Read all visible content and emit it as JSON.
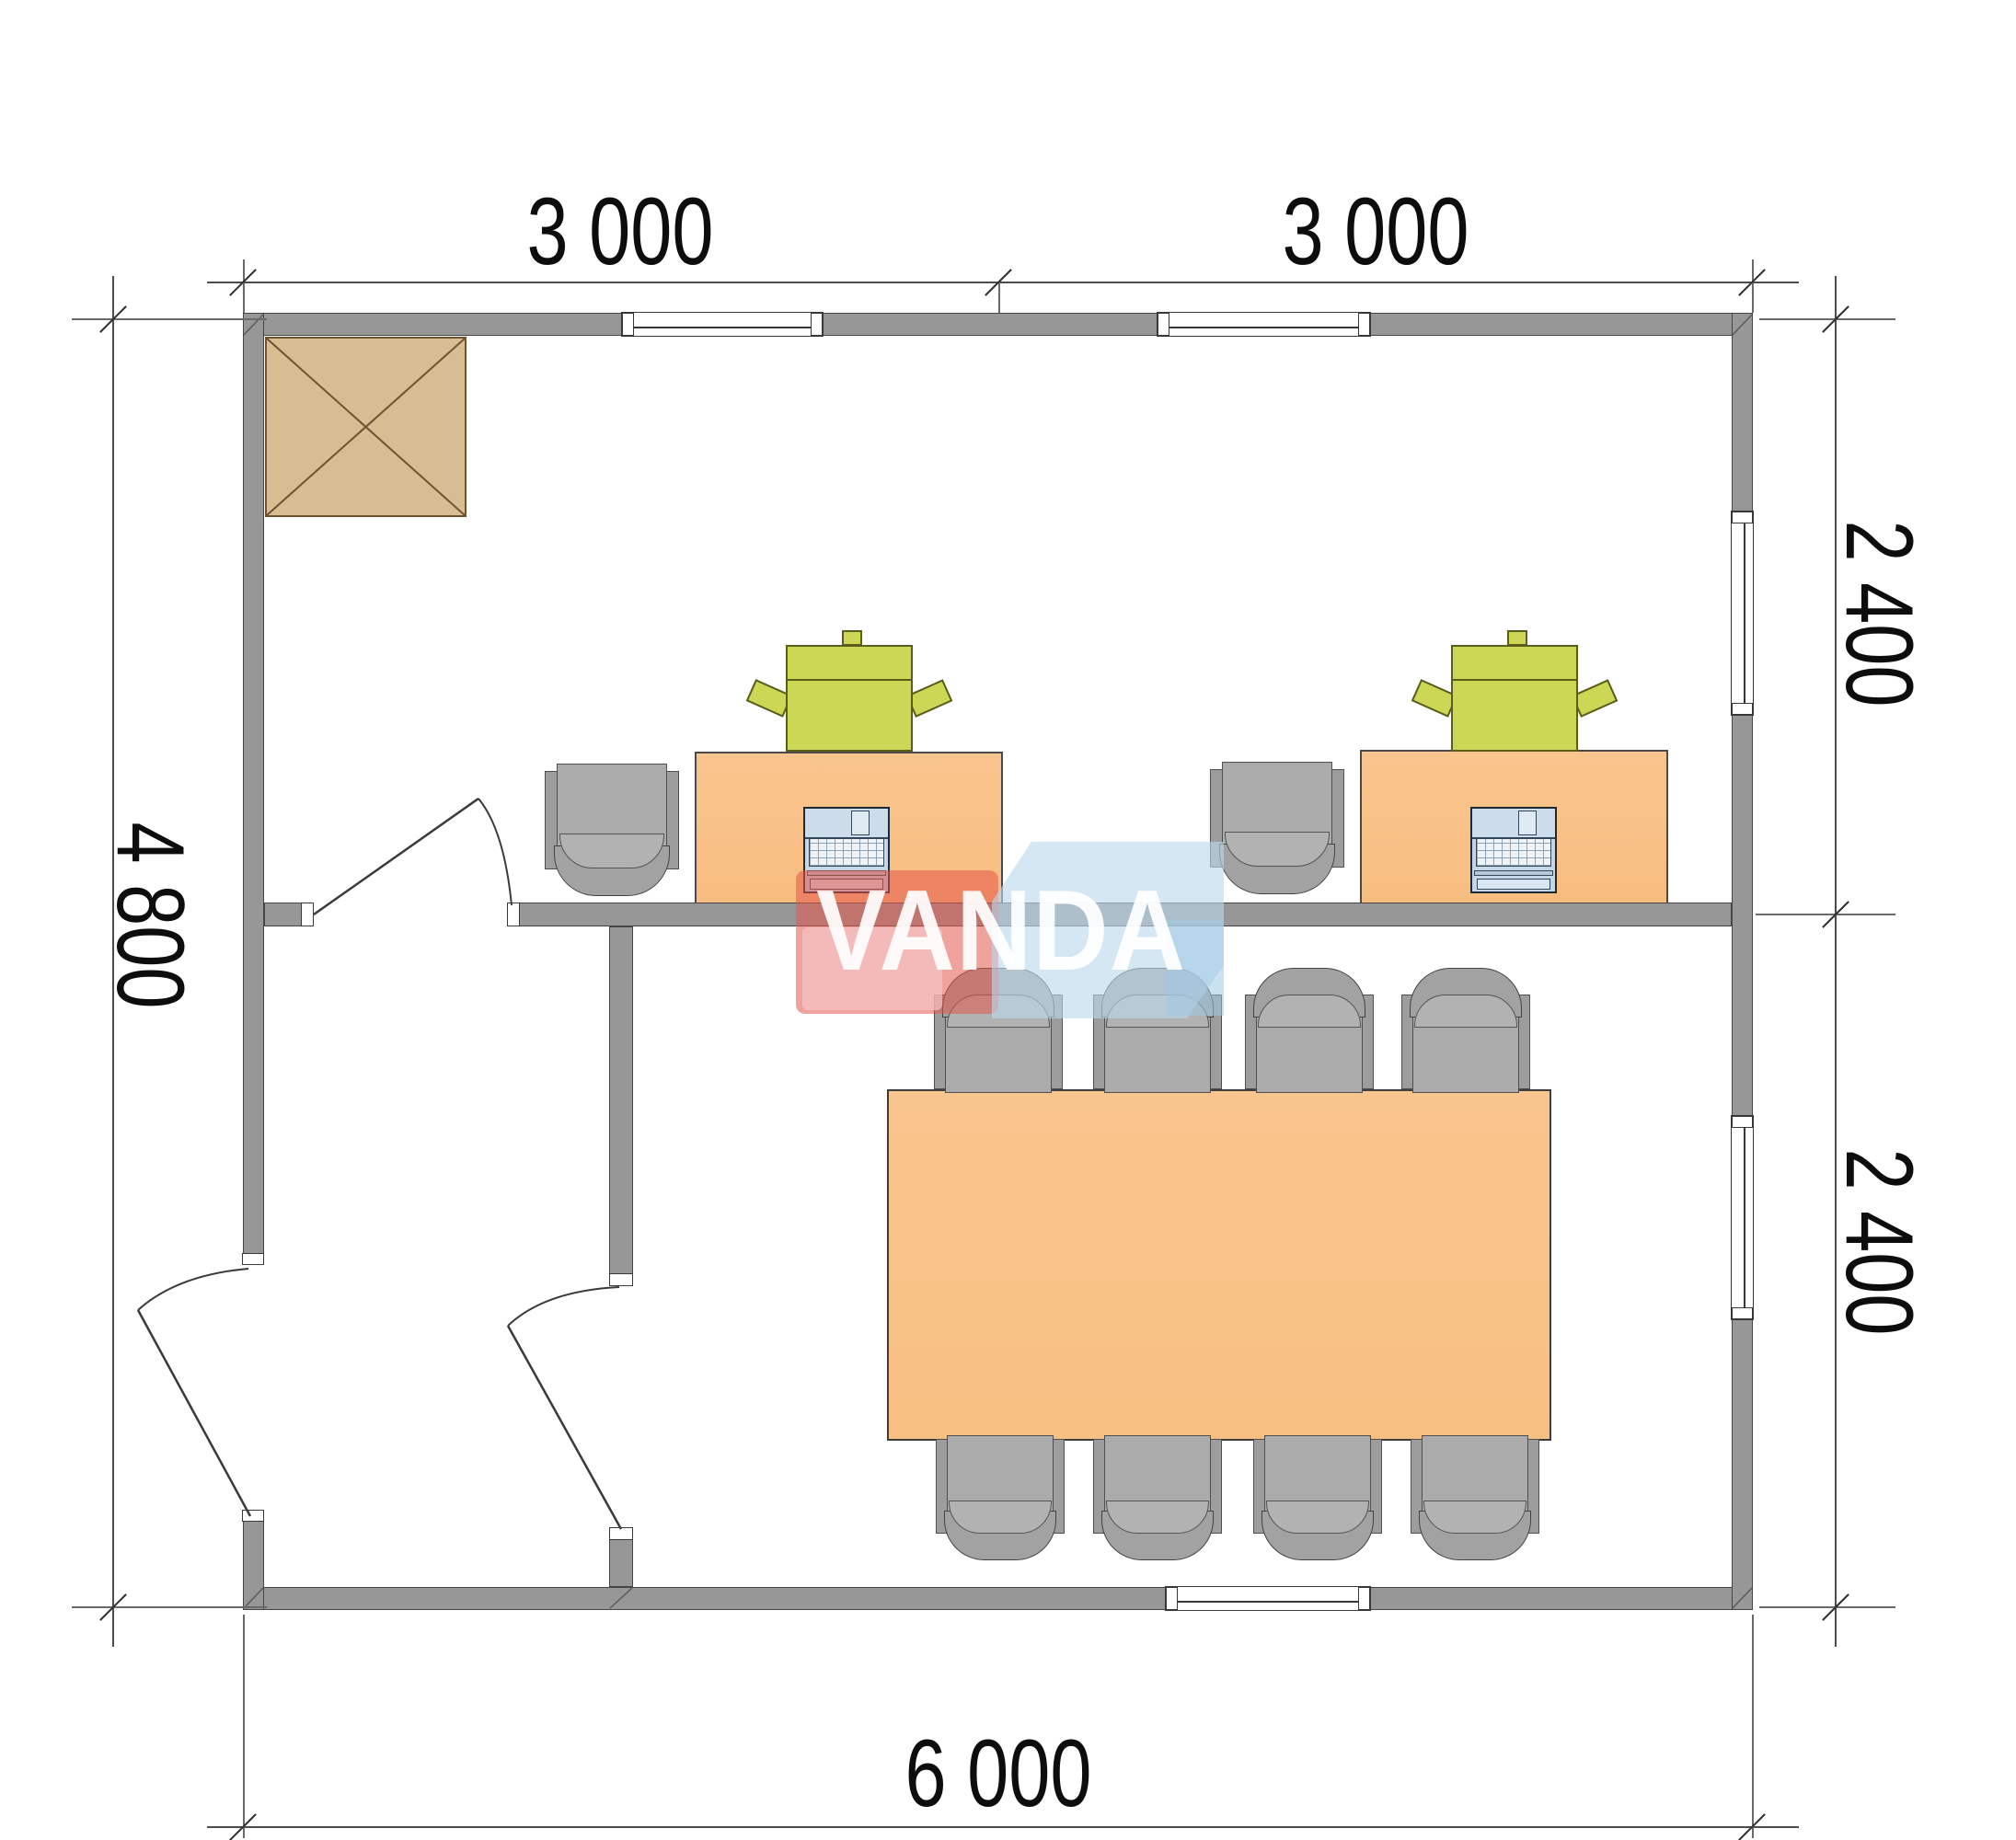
{
  "document": {
    "type": "floor-plan",
    "units": "mm",
    "building": {
      "width_label": "6 000",
      "depth_label": "4 800"
    }
  },
  "dimensions": {
    "top": [
      "3 000",
      "3 000"
    ],
    "right": [
      "2 400",
      "2 400"
    ],
    "left": "4 800",
    "bottom": "6 000"
  },
  "watermark": {
    "brand": "VANDA"
  },
  "colors": {
    "wall_fill": "#979797",
    "wall_stroke": "#454545",
    "desk_fill": "#f8c083",
    "printer_fill": "#cbd755",
    "chair_fill": "#ababab",
    "chimney_fill": "#d8bc92",
    "logo_red": "#e4564a",
    "logo_pink": "#f3c4c6",
    "logo_blue": "#bcd8eb",
    "logo_text": "#ffffff",
    "dimension_text": "#0d0d0d"
  },
  "rooms": {
    "office": {
      "furniture": [
        "desk-left",
        "desk-right",
        "office-chair-left",
        "office-chair-right",
        "printer-left",
        "printer-right",
        "laptop-left",
        "laptop-right",
        "chimney"
      ]
    },
    "meeting_room": {
      "furniture": [
        "conference-table",
        "conference-chairs-x8"
      ]
    },
    "entry_hall": {
      "furniture": []
    }
  },
  "openings": {
    "windows": [
      "top-wall-window-1",
      "top-wall-window-2",
      "right-wall-window-upper",
      "right-wall-window-lower",
      "bottom-wall-window"
    ],
    "doors": [
      "entrance-door-left-wall",
      "office-door-interior-wall",
      "meeting-room-door-partition"
    ]
  }
}
